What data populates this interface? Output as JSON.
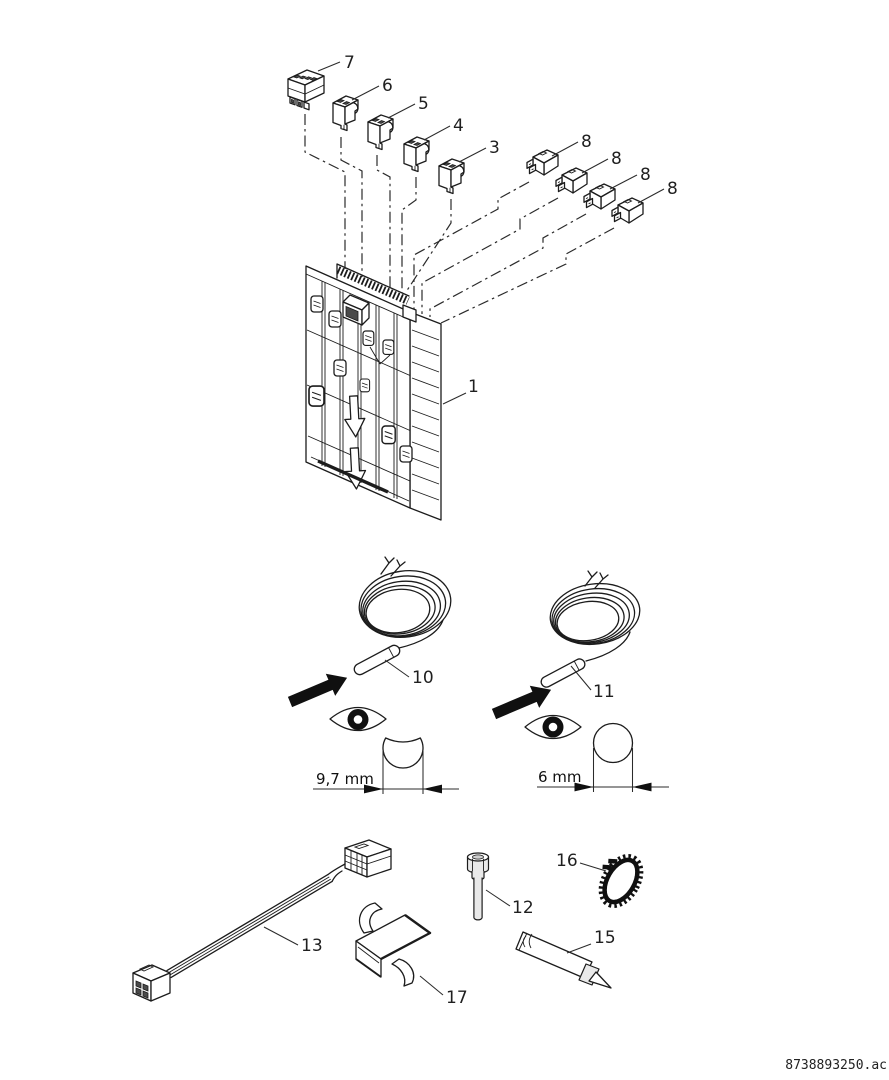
{
  "callouts": {
    "plate": "1",
    "conn3": "3",
    "conn4": "4",
    "conn5": "5",
    "conn6": "6",
    "conn7": "7",
    "conn8_1": "8",
    "conn8_2": "8",
    "conn8_3": "8",
    "conn8_4": "8",
    "sensor10": "10",
    "sensor11": "11",
    "sleeve12": "12",
    "cable13": "13",
    "paste15": "15",
    "clamp16": "16",
    "bracket17": "17"
  },
  "dimensions": {
    "sensor10_diameter": "9,7 mm",
    "sensor11_diameter": "6 mm"
  },
  "footer": {
    "code": "8738893250.ac"
  }
}
